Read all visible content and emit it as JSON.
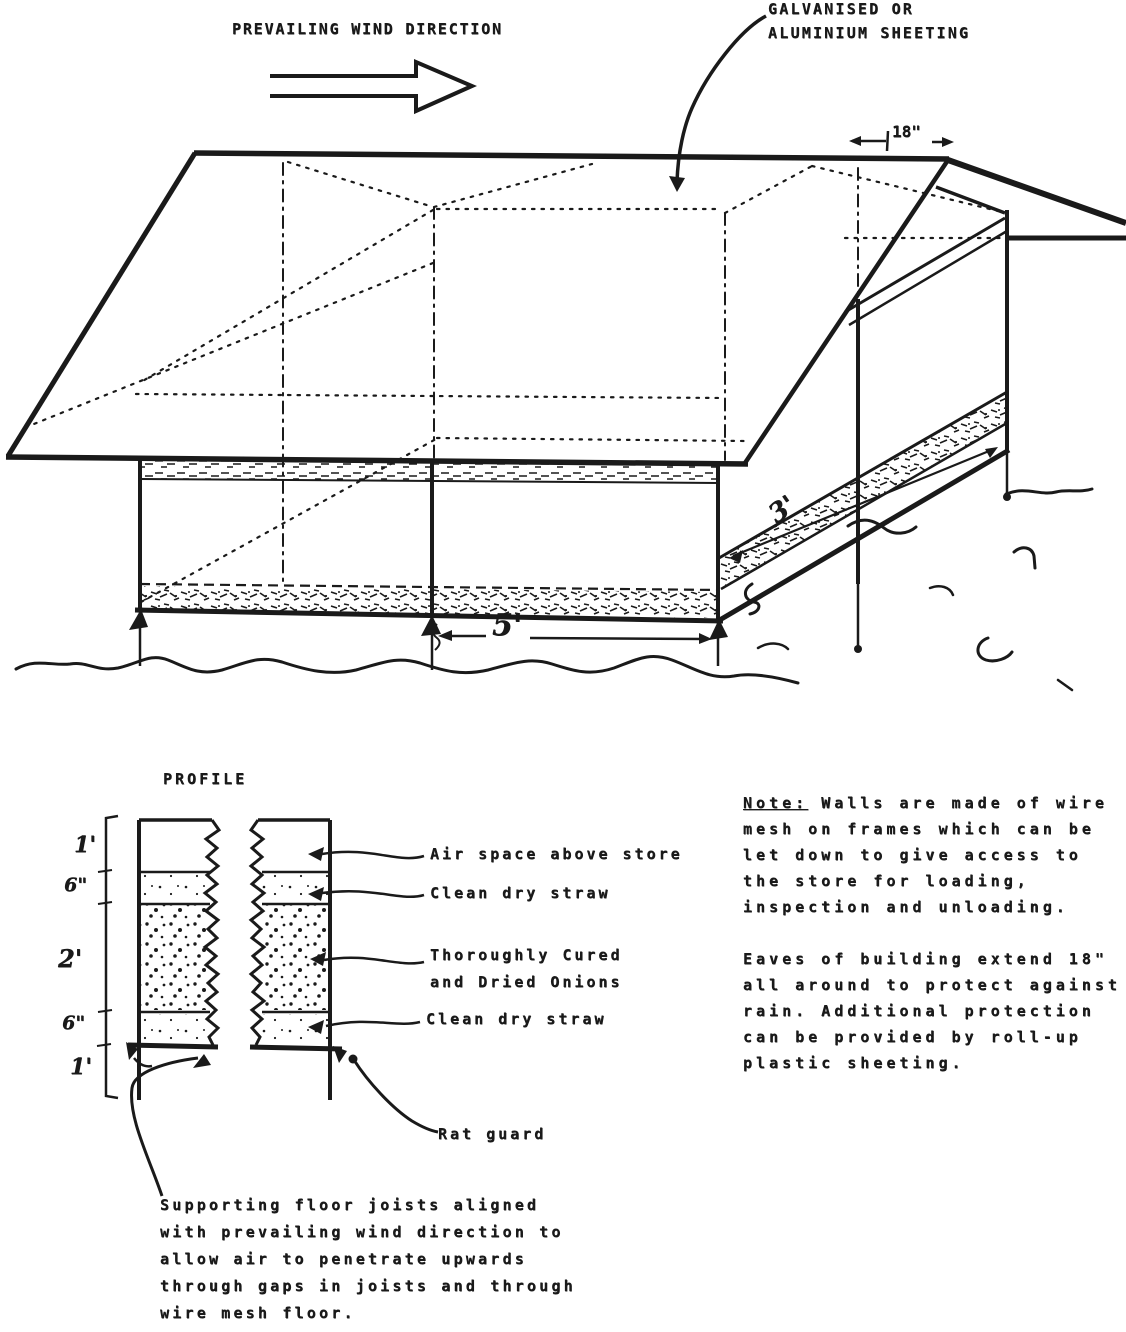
{
  "page": {
    "background": "#ffffff",
    "ink": "#1a1a1a"
  },
  "main_drawing": {
    "wind_label": "PREVAILING WIND DIRECTION",
    "sheeting_label_line1": "GALVANISED OR",
    "sheeting_label_line2": "ALUMINIUM SHEETING",
    "dim_eave_overhang": "18\"",
    "dim_front_bay": "5'",
    "dim_side_bay": "3'"
  },
  "profile": {
    "title": "PROFILE",
    "scale_marks": [
      "1'",
      "6\"",
      "2'",
      "6\"",
      "1'"
    ],
    "layer_labels": {
      "air": "Air space above store",
      "straw_top": "Clean dry straw",
      "onions_line1": "Thoroughly Cured",
      "onions_line2": "and Dried Onions",
      "straw_bottom": "Clean dry straw",
      "rat_guard": "Rat guard"
    },
    "joists_caption": [
      "Supporting floor joists aligned",
      "with prevailing wind direction to",
      "allow air to penetrate upwards",
      "through gaps in joists and through",
      "wire mesh floor."
    ]
  },
  "side_note": {
    "label": "Note:",
    "line1_rest": " Walls are made of wire",
    "para1": [
      "mesh on frames which can be",
      "let down to give access to",
      "the store for loading,",
      "inspection and unloading."
    ],
    "para2": [
      "Eaves of building extend 18\"",
      "all around to protect against",
      "rain. Additional protection",
      "can be provided by roll-up",
      "plastic sheeting."
    ]
  }
}
